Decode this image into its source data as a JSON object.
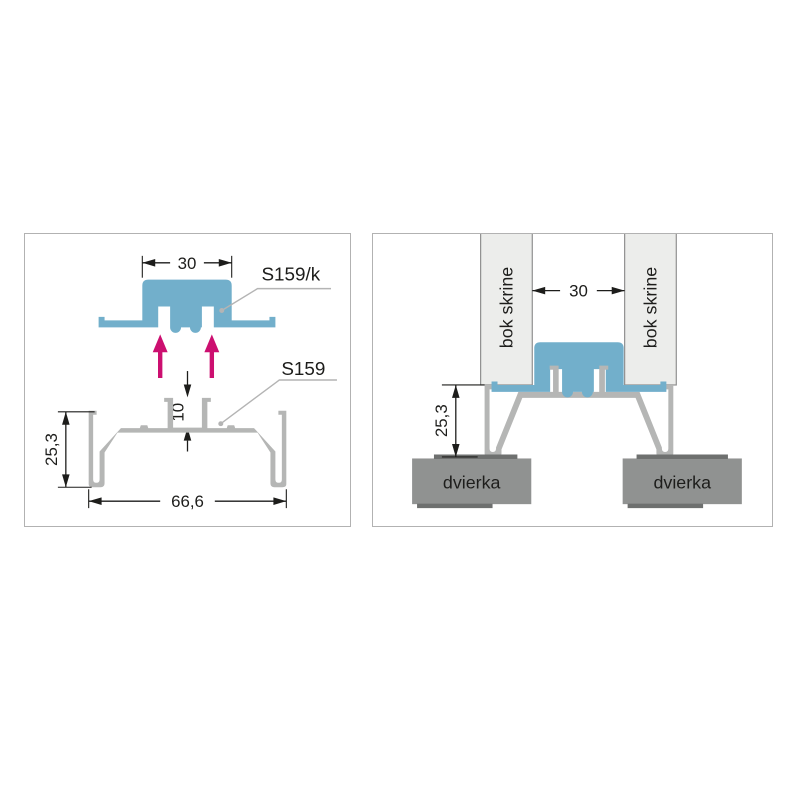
{
  "colors": {
    "profile_blue": "#72afcb",
    "profile_gray": "#b5b6b5",
    "cabinet_panel": "#ecedeb",
    "bar_border": "#8f8f8f",
    "door_gray": "#909291",
    "door_edge": "#6e706f",
    "line": "#1d1d1b",
    "leader": "#b4b4b4",
    "accent": "#cc0f70",
    "panel_border": "#b2b2b2"
  },
  "left_panel": {
    "labels": {
      "top_profile": "S159/k",
      "bottom_profile": "S159"
    },
    "dimensions": {
      "top_width": "30",
      "channel_depth": "10",
      "profile_height": "25,3",
      "total_width": "66,6"
    }
  },
  "right_panel": {
    "labels": {
      "cabinet_side_left": "bok skrine",
      "cabinet_side_right": "bok skrine",
      "door_left": "dvierka",
      "door_right": "dvierka"
    },
    "dimensions": {
      "gap_width": "30",
      "profile_height": "25,3"
    }
  }
}
